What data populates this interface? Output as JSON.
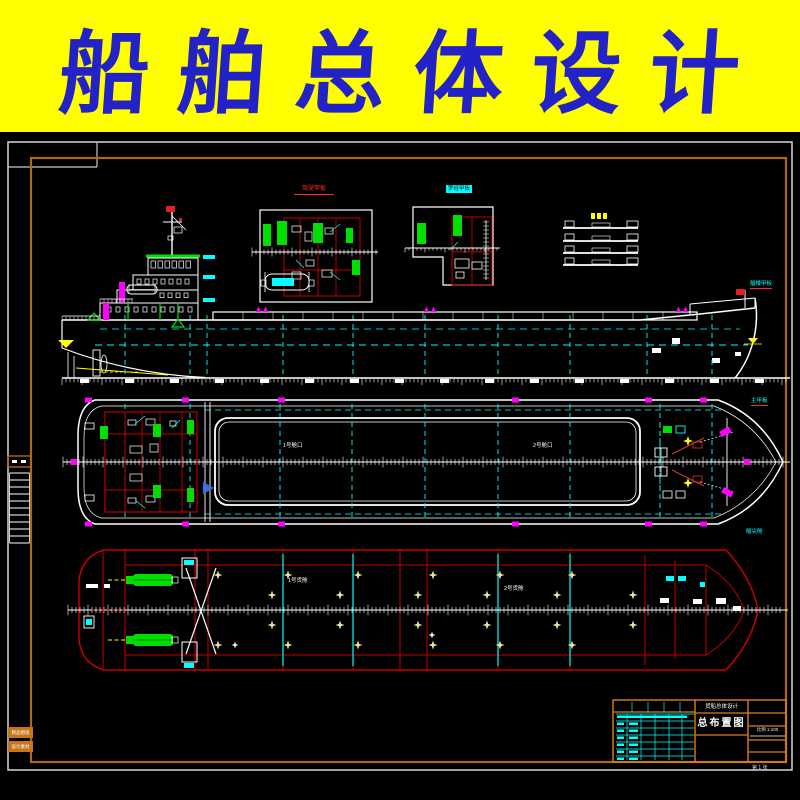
{
  "banner": {
    "title": "船舶总体设计",
    "bg_color": "#FFFF00",
    "text_color": "#2222C6"
  },
  "drawing": {
    "background": "#000000",
    "frame_color": "#AA6A14",
    "title_block_color": "#E07D18",
    "line_colors": {
      "main": "#FFFFFF",
      "bulkhead_cyan": "#00FFFF",
      "fittings_green": "#00E000",
      "vents_magenta": "#FF00FF",
      "marks_yellow": "#FFFF00",
      "structure_red": "#C40000",
      "stars_cream": "#EBDFA0",
      "flag_red": "#E02020"
    },
    "labels": {
      "detail1": "驾驶甲板",
      "detail2": "罗经甲板",
      "side_bow": "艏楼甲板",
      "plan_deck": "主甲板",
      "plan_bow": "艏尖舱",
      "plan_hatch1": "1号舱口",
      "plan_hatch2": "2号舱口",
      "bottom_hold1": "1号货舱",
      "bottom_hold2": "2号货舱"
    },
    "title_block": {
      "project": "货船总体设计",
      "title": "总布置图",
      "row": "比例 1:100",
      "sheet": "第 1 张"
    },
    "stamps": [
      "精品图纸",
      "设计素材"
    ]
  }
}
